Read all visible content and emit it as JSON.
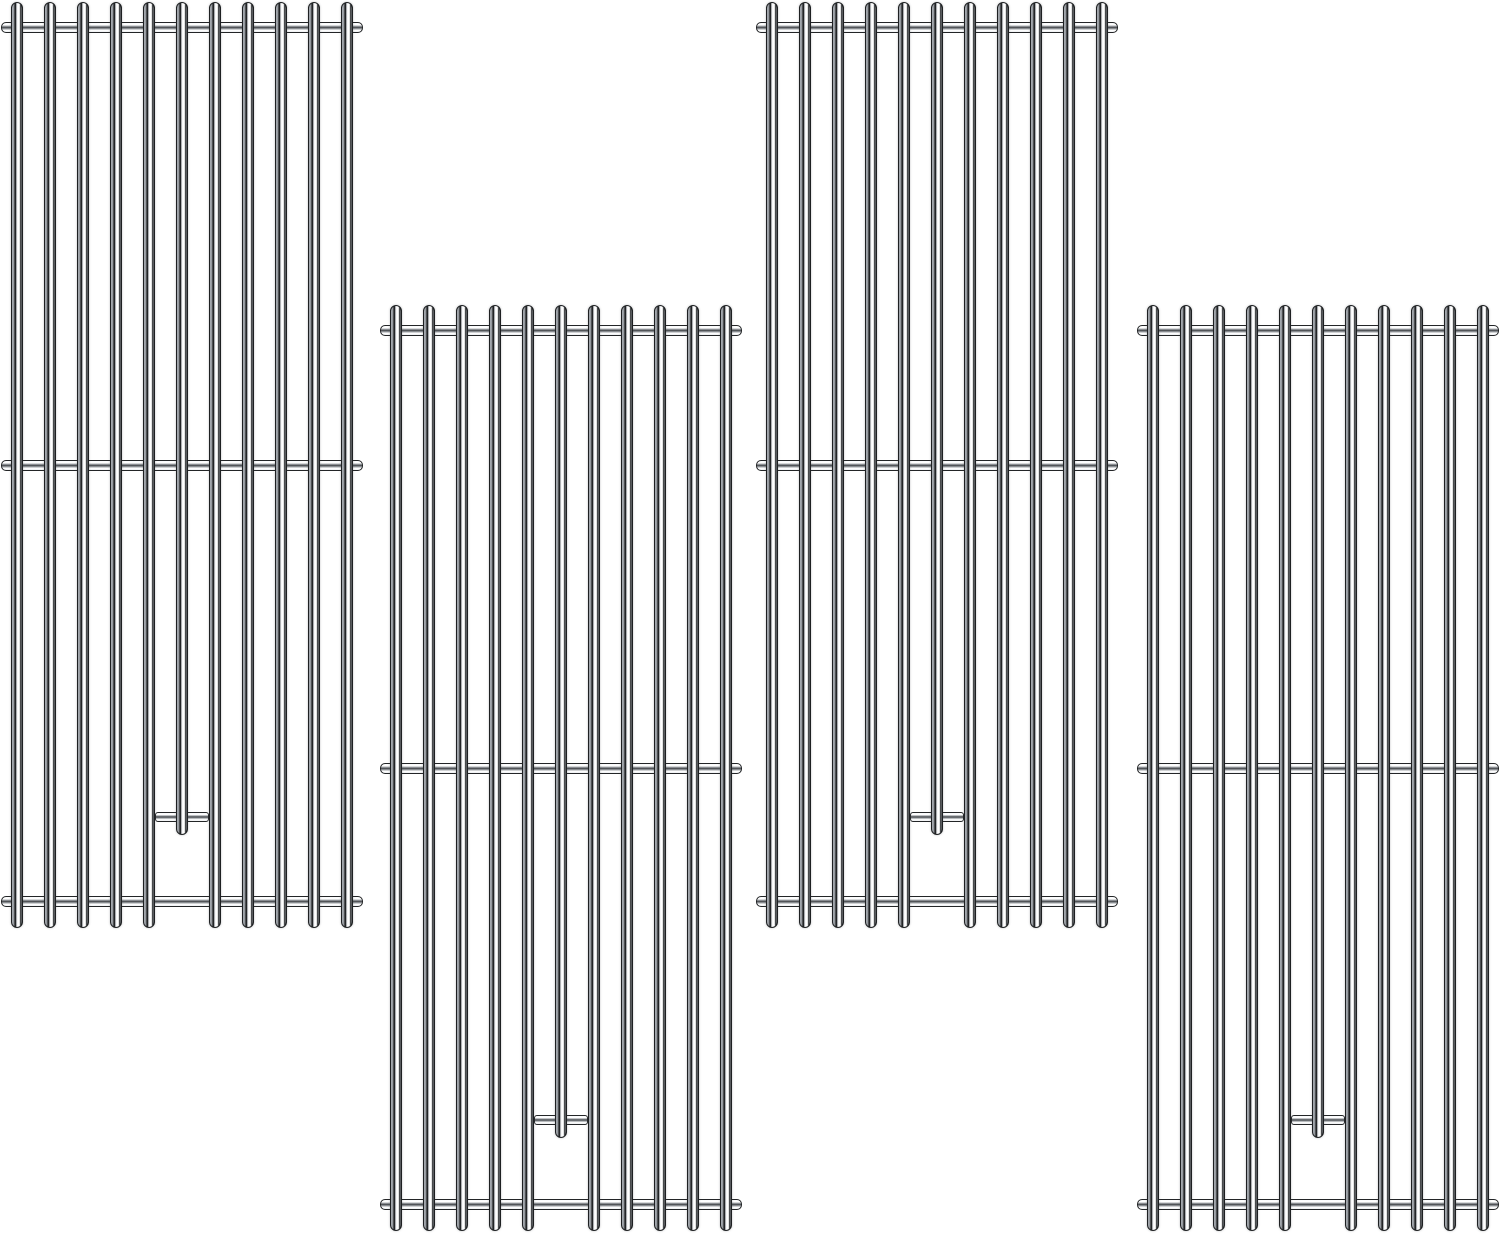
{
  "scene": {
    "description": "Product illustration of four identical stainless steel replacement grill cooking grates on a plain white background, arranged in two vertically staggered pairs (columns 1 and 3 high, columns 2 and 4 low)",
    "background_color": "#ffffff",
    "grate_count": 4,
    "steel_colors": {
      "outline": "#1e2022",
      "mid_gray": "#8f9499",
      "highlight": "#ffffff"
    }
  },
  "grate_template": {
    "width": 362,
    "height": 928,
    "rod_count": 11,
    "rod_width": 12,
    "rod_spacing": 33,
    "first_rod_center_x": 16,
    "full_rod_height": 926,
    "short_rod_index": 5,
    "short_rod_height": 833,
    "short_rod_bracket": {
      "x": 154,
      "y": 810,
      "width": 54,
      "height": 10
    },
    "crossbar_y": [
      20,
      458,
      894
    ],
    "crossbar_height": 11
  },
  "grates": [
    {
      "id": "grill-grate-1",
      "x": 1,
      "y": 2
    },
    {
      "id": "grill-grate-2",
      "x": 380,
      "y": 305
    },
    {
      "id": "grill-grate-3",
      "x": 756,
      "y": 2
    },
    {
      "id": "grill-grate-4",
      "x": 1137,
      "y": 305
    }
  ]
}
